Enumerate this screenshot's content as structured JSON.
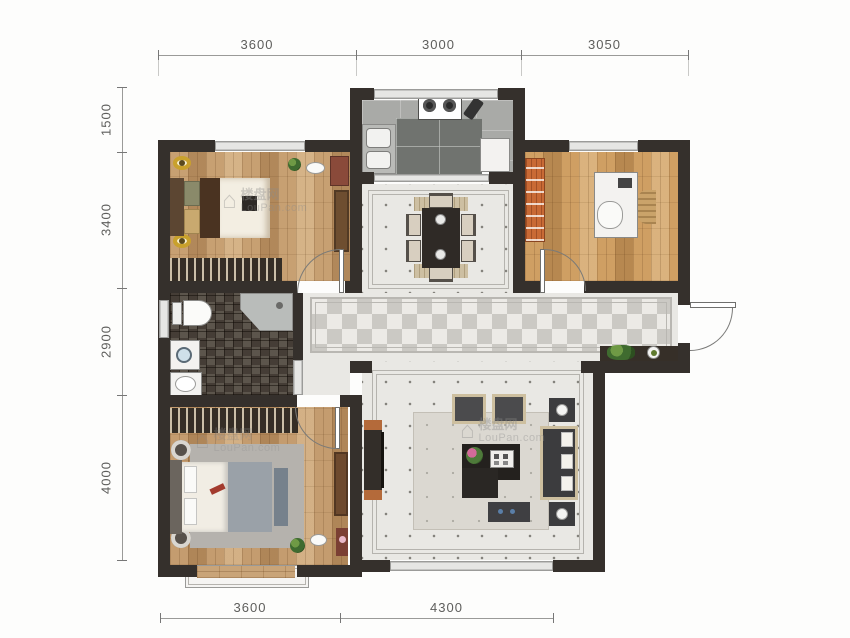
{
  "plan": {
    "type": "residential-floor-plan",
    "dimensions_mm": {
      "top": [
        "3600",
        "3000",
        "3050"
      ],
      "left": [
        "1500",
        "3400",
        "2900",
        "4000"
      ],
      "bottom": [
        "3600",
        "4300"
      ]
    },
    "watermarks": [
      {
        "cn": "楼盘网",
        "en": "LouPan.com"
      },
      {
        "cn": "楼盘网",
        "en": "LouPan.com"
      },
      {
        "cn": "楼盘网",
        "en": "LouPan.com"
      }
    ],
    "colors": {
      "wall": "#35302c",
      "wood_floor": "#c7a072",
      "tile_light": "#e9e8e4",
      "bathroom_mosaic": "#4e463d",
      "kitchen_gray": "#a9aaa7",
      "accent_orange": "#c96a35",
      "lamp_gold": "#c9a12c"
    }
  }
}
